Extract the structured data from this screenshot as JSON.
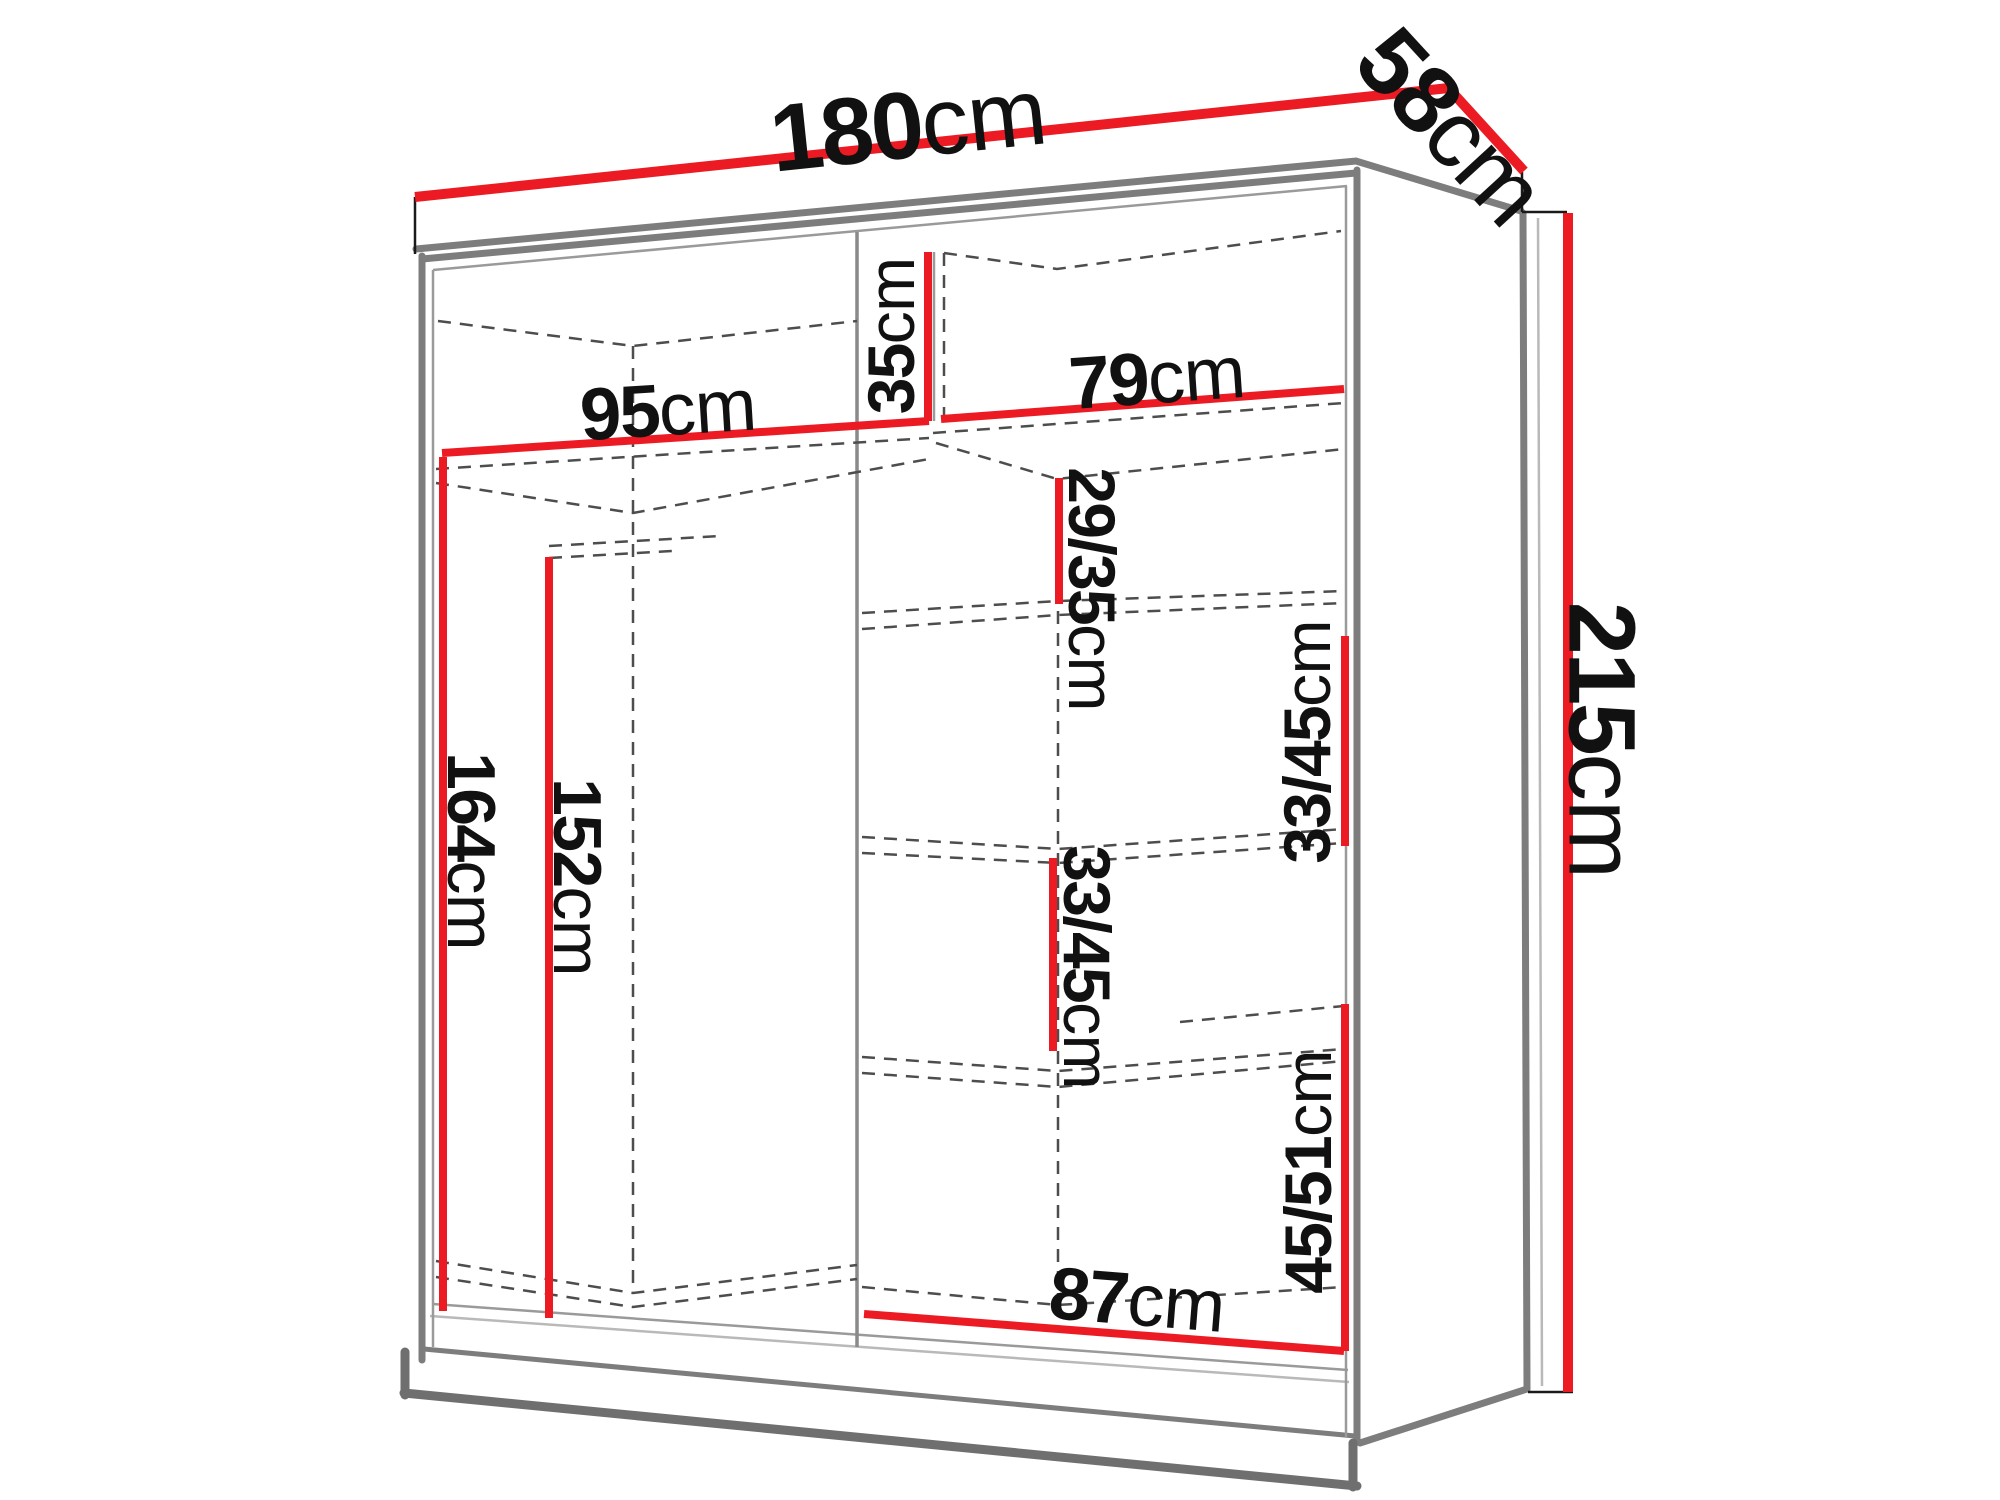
{
  "diagram": {
    "type": "furniture-dimension-diagram",
    "subject": "wardrobe with interior shelves and hanging section"
  },
  "colors": {
    "accent": "#ec1b23",
    "structure": "#7d7d7d",
    "dashed": "#4d4d4d",
    "background": "#ffffff",
    "text": "#111111"
  },
  "measurements": {
    "width": {
      "value": "180",
      "unit": "cm"
    },
    "depth": {
      "value": "58",
      "unit": "cm"
    },
    "height": {
      "value": "215",
      "unit": "cm"
    },
    "top_shelf_left_width": {
      "value": "95",
      "unit": "cm"
    },
    "top_shelf_height": {
      "value": "35",
      "unit": "cm"
    },
    "top_shelf_right_width": {
      "value": "79",
      "unit": "cm"
    },
    "right_gap_top": {
      "value": "29/35",
      "unit": "cm"
    },
    "right_gap_upper": {
      "value": "33/45",
      "unit": "cm"
    },
    "right_gap_lower": {
      "value": "33/45",
      "unit": "cm"
    },
    "right_gap_bottom": {
      "value": "45/51",
      "unit": "cm"
    },
    "hanging_height_outer": {
      "value": "164",
      "unit": "cm"
    },
    "hanging_height_inner": {
      "value": "152",
      "unit": "cm"
    },
    "bottom_shelf_width": {
      "value": "87",
      "unit": "cm"
    }
  }
}
